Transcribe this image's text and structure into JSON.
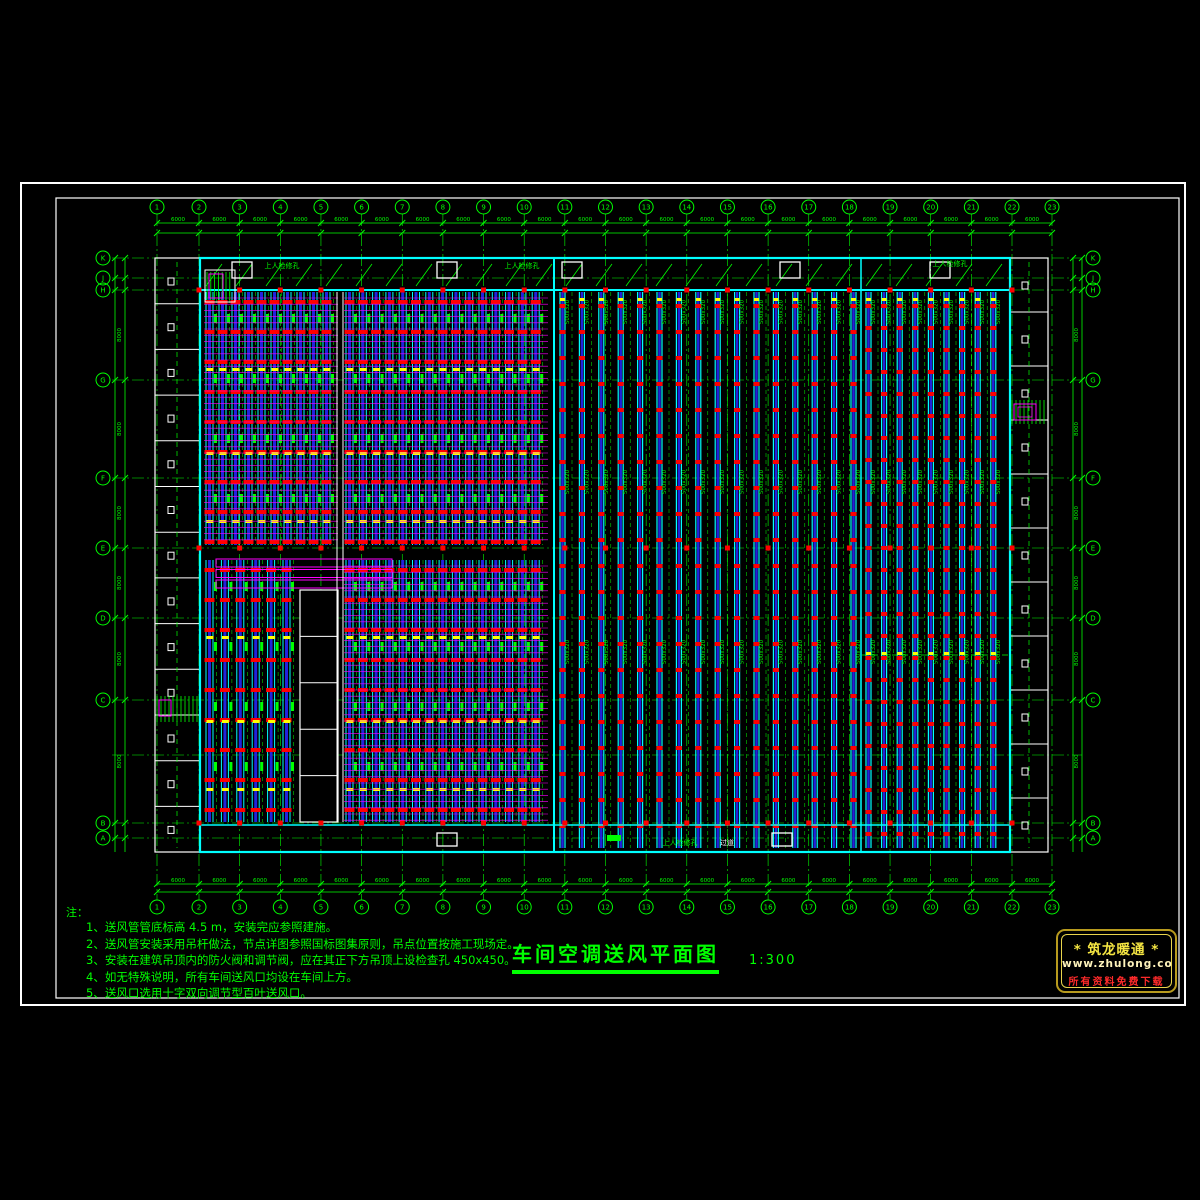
{
  "drawing": {
    "title": "车间空调送风平面图",
    "scale": "1:300",
    "notes": {
      "heading": "注：",
      "items": [
        "1、送风管管底标高  4.5 m，安装完应参照建施。",
        "2、送风管安装采用吊杆做法，节点详图参照国标图集原则，吊点位置按施工现场定。",
        "3、安装在建筑吊顶内的防火阀和调节阀，应在其正下方吊顶上设检查孔 450x450。",
        "4、如无特殊说明，所有车间送风口均设在车间上方。",
        "5、送风口选用十字双向调节型百叶送风口。"
      ]
    },
    "logo": {
      "brand": "* 筑龙暖通 *",
      "url": "www.zhulong.com",
      "tagline": "所有资料免费下载"
    },
    "labels": {
      "access_hole": "上人检修孔",
      "corridor": "过道",
      "duct_size": "500x320",
      "dim_h": "6000",
      "dim_v": "8000"
    },
    "grid": {
      "column_labels": [
        "1",
        "2",
        "3",
        "4",
        "5",
        "6",
        "7",
        "8",
        "9",
        "10",
        "11",
        "12",
        "13",
        "14",
        "15",
        "16",
        "17",
        "18",
        "19",
        "20",
        "21",
        "22",
        "23"
      ],
      "row_labels": [
        "K",
        "J",
        "H",
        "G",
        "F",
        "E",
        "D",
        "C",
        "B",
        "A"
      ],
      "row_y": [
        258,
        278,
        290,
        380,
        478,
        548,
        618,
        700,
        823,
        838
      ]
    },
    "colors": {
      "bg": "#000000",
      "green": "#00FF00",
      "cyan": "#00FFFF",
      "blue": "#2222DD",
      "magenta": "#FF00FF",
      "red": "#FF0000",
      "yellow": "#FFFF00",
      "white": "#FFFFFF"
    }
  }
}
